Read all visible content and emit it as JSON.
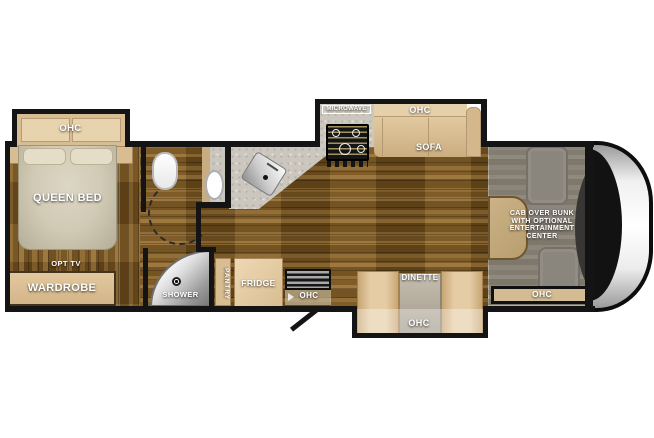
{
  "diagram_type": "rv-floorplan",
  "colors": {
    "wall": "#141414",
    "cabinet_tan": "#d9bd92",
    "counter_gray": "#cbc7be",
    "wood_floor": "#7c5823",
    "label_text": "#ffffff"
  },
  "bedroom": {
    "ohc_label": "OHC",
    "bed_label": "QUEEN BED",
    "opt_tv_label": "OPT TV",
    "wardrobe_label": "WARDROBE"
  },
  "bathroom": {
    "shower_label": "SHOWER"
  },
  "kitchen": {
    "pantry_label": "PANTRY",
    "fridge_label": "FRIDGE",
    "microwave_label": "MICROWAVE",
    "entry_ohc_label": "OHC"
  },
  "living": {
    "sofa_ohc_label": "OHC",
    "sofa_label": "SOFA",
    "dinette_label": "DINETTE",
    "dinette_ohc_label": "OHC"
  },
  "cab": {
    "bunk_lines": [
      "CAB OVER BUNK",
      "WITH OPTIONAL",
      "ENTERTAINMENT",
      "CENTER"
    ],
    "ohc_label": "OHC"
  }
}
